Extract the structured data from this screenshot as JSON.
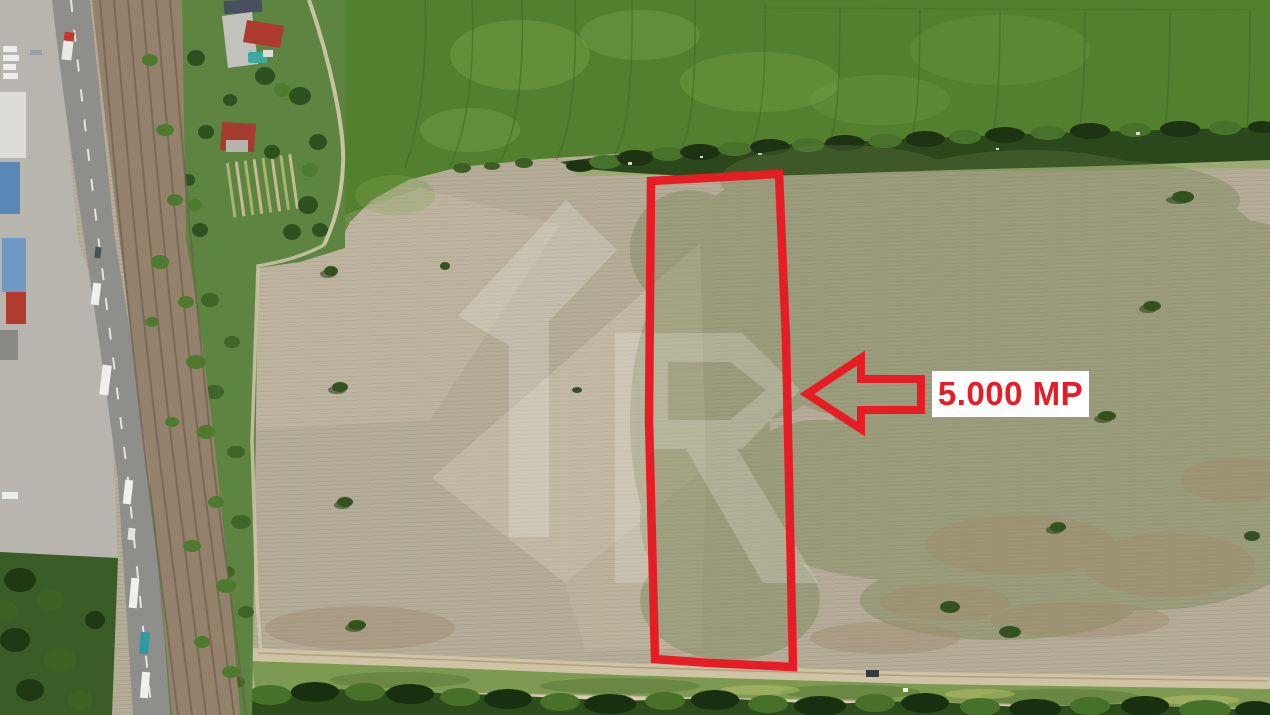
{
  "annotation": {
    "area_label": "5.000 MP",
    "accent_color": "#e71d25",
    "label_bg_color": "#ffffff"
  }
}
